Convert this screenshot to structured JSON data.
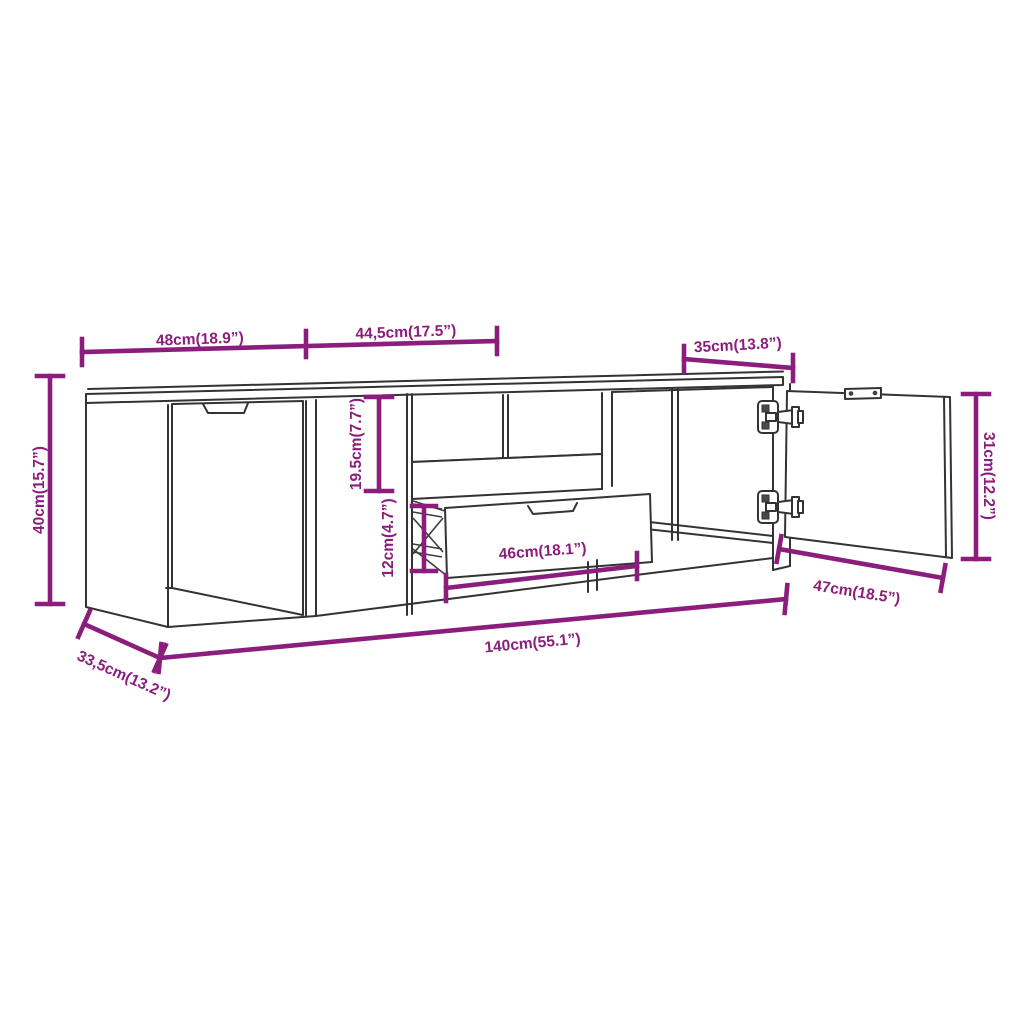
{
  "figure": {
    "kind": "furniture-dimension-line-drawing",
    "background_color": "#ffffff",
    "line_color": "#333333",
    "dimension_color": "#8B1E7D",
    "icons": {
      "hinge": "hinge-icon",
      "mounting_plate": "mounting-plate-icon",
      "handle_notch": "handle-notch-icon"
    }
  },
  "dimensions": {
    "top_left_width": "48cm(18.9”)",
    "top_middle_width": "44,5cm(17.5”)",
    "top_right_width": "35cm(13.8”)",
    "overall_height": "40cm(15.7”)",
    "niche_height": "19.5cm(7.7”)",
    "drawer_opening_height": "12cm(4.7”)",
    "drawer_width": "46cm(18.1”)",
    "door_width": "47cm(18.5”)",
    "door_height": "31cm(12.2”)",
    "overall_width": "140cm(55.1”)",
    "overall_depth": "33,5cm(13.2”)"
  }
}
